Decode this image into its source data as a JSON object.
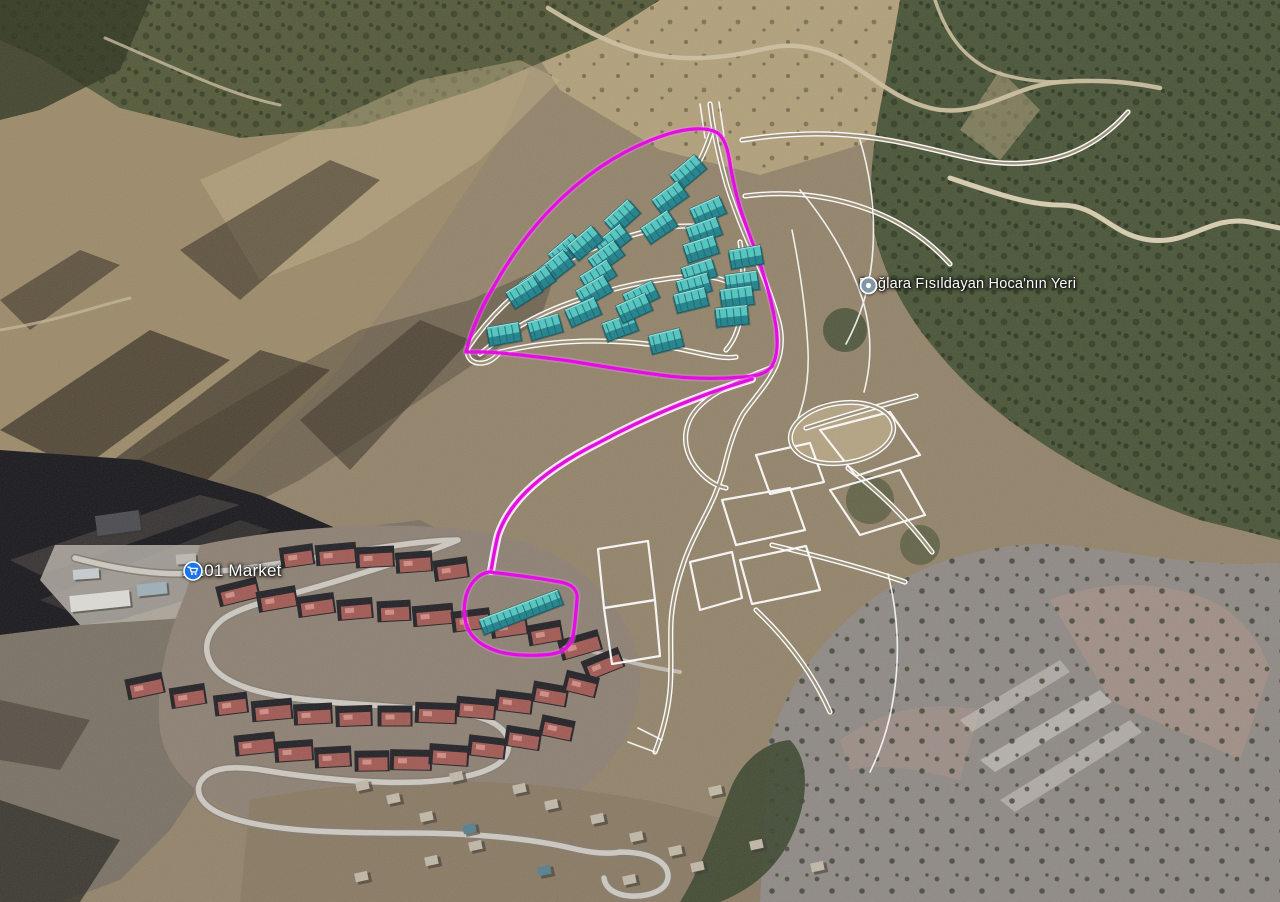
{
  "map": {
    "view": "satellite-3d",
    "pois": [
      {
        "id": "hoca",
        "label": "Dağlara Fısıldayan Hoca'nın Yeri",
        "icon": "location-dot-pin",
        "icon_color": "#8297a5",
        "x": 869,
        "y": 284
      },
      {
        "id": "a101",
        "label": "A101 Market",
        "icon": "shopping-cart-pin",
        "icon_color": "#1a73e8",
        "x": 193,
        "y": 571
      }
    ],
    "overlay": {
      "boundary_color": "#e800e8",
      "boundary_glow": "#ff86ff",
      "planned_road_color": "#ffffff",
      "planned_road_inner": "#9d9077",
      "building_top": "#52c6c0",
      "building_front": "#1f828c",
      "building_line": "#145f68",
      "boundary_paths": {
        "upper_site": "M466,352 C472,328 482,306 494,286 C512,254 536,222 564,196 C594,168 630,146 668,134 C688,128 706,127 716,132 C723,136 727,146 729,158 C732,176 736,196 742,214 C749,234 756,252 762,270 C768,288 773,308 776,326 C778,342 778,356 772,366 C766,374 756,376 744,377 C720,379 690,379 660,375 C630,371 600,366 570,361 C540,357 508,353 484,352 Z",
        "corridor": "M752,379 C700,395 648,416 600,442 C570,457 544,474 526,492 C512,506 503,520 498,535 C495,547 493,559 491,571",
        "lower_site": "M489,572 C516,575 544,579 560,582 C572,584 578,590 577,599 C576,612 575,626 573,636 C571,646 564,652 552,654 C538,656 516,656 500,652 C486,648 475,641 469,631 C464,622 463,609 466,596 C469,585 477,574 489,572 Z"
      },
      "planned_roads": [
        "M710,104 C713,130 719,158 727,186 C736,214 747,240 758,264 C767,284 774,304 779,322 C783,338 782,352 776,366 C768,384 754,398 743,414 C735,428 730,444 726,460 C722,478 716,494 708,510 C698,530 688,548 682,568 C676,586 672,604 671,622 C670,646 672,668 670,690 C668,712 662,734 655,752",
        "M776,366 C754,374 730,384 712,396 C697,406 688,418 686,432 C684,446 689,460 699,471 C707,480 716,486 726,488",
        "M742,140 C780,134 820,132 858,136 C900,140 940,152 978,160 C1010,166 1040,164 1068,154 C1092,145 1112,130 1128,112",
        "M745,196 C790,190 835,196 875,212 C905,224 930,242 950,264",
        "M806,428 C840,417 878,406 916,396",
        "M848,468 C880,492 908,520 932,552",
        "M772,545 C818,556 864,568 905,582",
        "M756,610 C790,642 814,676 830,712",
        "M468,348 C488,318 516,290 550,270 C580,252 612,240 644,232 C668,226 692,224 710,228",
        "M480,354 C506,332 538,314 572,302 C606,290 640,282 672,278 C696,275 716,276 728,282",
        "M500,352 C530,345 562,341 594,341 C630,341 664,345 694,352 C712,356 726,359 736,357",
        "M740,242 C744,268 744,294 740,318 C738,332 733,342 726,350",
        "M712,130 C706,150 698,166 688,180",
        "M468,348 C466,356 470,362 478,363 C486,364 494,360 500,352"
      ],
      "parcels": [
        "M756,455 L810,443 L824,482 L770,494 Z",
        "M722,500 L790,488 L805,530 L736,545 Z",
        "M740,560 L806,546 L820,590 L752,604 Z",
        "M690,562 L732,552 L742,598 L700,610 Z",
        "M820,430 L890,412 L920,455 L856,476 Z",
        "M830,490 L900,470 L925,515 L860,535 Z",
        "M598,549 L648,541 L655,600 L604,608 Z",
        "M604,608 L655,600 L660,656 L612,664 Z"
      ],
      "ring": {
        "cx": 842,
        "cy": 433,
        "rx": 52,
        "ry": 30,
        "rot": -8
      },
      "thin_lines": [
        "M800,190 C830,226 850,262 862,298 C872,330 872,362 864,392",
        "M860,140 C872,180 876,220 872,260 C869,290 860,318 846,344",
        "M700,104 L705,138",
        "M719,102 L724,136",
        "M792,230 C800,270 806,310 808,350 C809,375 806,398 798,418",
        "M888,574 C898,614 900,654 894,694 C890,722 882,748 870,772",
        "M628,742 L655,752 M638,728 L662,740"
      ],
      "proposed_blocks": [
        [
          688,
          172,
          -40
        ],
        [
          670,
          198,
          -36
        ],
        [
          708,
          211,
          -24
        ],
        [
          659,
          227,
          -34
        ],
        [
          704,
          231,
          -20
        ],
        [
          701,
          249,
          -18
        ],
        [
          622,
          217,
          -42
        ],
        [
          613,
          241,
          -38
        ],
        [
          606,
          257,
          -36
        ],
        [
          598,
          276,
          -32
        ],
        [
          594,
          291,
          -30
        ],
        [
          566,
          251,
          -40
        ],
        [
          556,
          267,
          -38
        ],
        [
          537,
          282,
          -34
        ],
        [
          524,
          292,
          -32
        ],
        [
          583,
          312,
          -24
        ],
        [
          545,
          327,
          -16
        ],
        [
          504,
          334,
          -10
        ],
        [
          620,
          327,
          -20
        ],
        [
          666,
          341,
          -14
        ],
        [
          641,
          296,
          -26
        ],
        [
          634,
          308,
          -24
        ],
        [
          699,
          272,
          -18
        ],
        [
          694,
          286,
          -16
        ],
        [
          691,
          300,
          -14
        ],
        [
          746,
          257,
          -10
        ],
        [
          742,
          282,
          -8
        ],
        [
          737,
          297,
          -8
        ],
        [
          732,
          316,
          -6
        ],
        [
          585,
          243,
          -40
        ]
      ],
      "lower_block": [
        521,
        612,
        -21,
        84,
        16
      ]
    },
    "imagery": {
      "existing_blocks": [
        [
          297,
          556,
          -8
        ],
        [
          336,
          554,
          -5
        ],
        [
          375,
          557,
          -3
        ],
        [
          414,
          562,
          -4
        ],
        [
          451,
          569,
          -8
        ],
        [
          238,
          592,
          -14
        ],
        [
          277,
          599,
          -10
        ],
        [
          316,
          605,
          -8
        ],
        [
          355,
          609,
          -5
        ],
        [
          394,
          611,
          -3
        ],
        [
          433,
          615,
          -5
        ],
        [
          471,
          620,
          -7
        ],
        [
          509,
          626,
          -8
        ],
        [
          545,
          633,
          -10
        ],
        [
          580,
          645,
          -16
        ],
        [
          603,
          664,
          -22
        ],
        [
          145,
          686,
          -12
        ],
        [
          188,
          696,
          -9
        ],
        [
          231,
          704,
          -7
        ],
        [
          272,
          710,
          -5
        ],
        [
          313,
          714,
          -3
        ],
        [
          354,
          716,
          -2
        ],
        [
          395,
          716,
          0
        ],
        [
          436,
          713,
          2
        ],
        [
          476,
          708,
          5
        ],
        [
          514,
          702,
          7
        ],
        [
          550,
          694,
          10
        ],
        [
          581,
          684,
          14
        ],
        [
          255,
          744,
          -6
        ],
        [
          294,
          751,
          -4
        ],
        [
          333,
          757,
          -3
        ],
        [
          372,
          761,
          -1
        ],
        [
          411,
          760,
          1
        ],
        [
          449,
          755,
          4
        ],
        [
          487,
          747,
          7
        ],
        [
          523,
          738,
          9
        ],
        [
          557,
          728,
          12
        ]
      ],
      "village_houses": [
        [
          363,
          786
        ],
        [
          394,
          799
        ],
        [
          427,
          817
        ],
        [
          457,
          777
        ],
        [
          520,
          789
        ],
        [
          552,
          805
        ],
        [
          598,
          819
        ],
        [
          637,
          837
        ],
        [
          676,
          851
        ],
        [
          716,
          791
        ],
        [
          757,
          845
        ],
        [
          818,
          867
        ],
        [
          698,
          867
        ],
        [
          476,
          846
        ],
        [
          432,
          861
        ],
        [
          362,
          877
        ],
        [
          630,
          880
        ]
      ],
      "blue_roofs": [
        [
          545,
          871
        ],
        [
          470,
          829
        ]
      ],
      "industrial": [
        [
          100,
          601,
          60,
          16,
          -6,
          "#dcdad4"
        ],
        [
          152,
          589,
          30,
          12,
          -6,
          "#9fb0b8"
        ],
        [
          86,
          574,
          26,
          10,
          -4,
          "#c6cccf"
        ],
        [
          186,
          559,
          20,
          10,
          -4,
          "#bdb9b1"
        ],
        [
          118,
          523,
          44,
          20,
          -8,
          "#4c4c50"
        ]
      ]
    }
  }
}
